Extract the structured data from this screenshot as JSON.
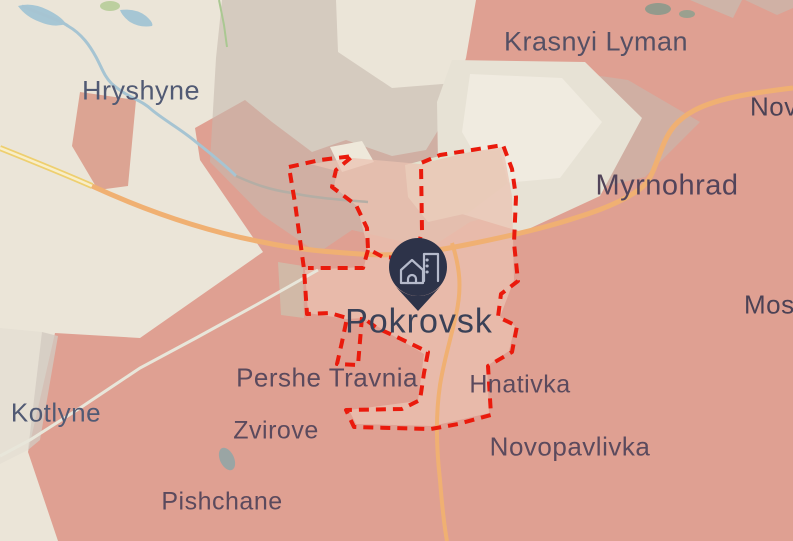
{
  "map": {
    "labels": [
      {
        "text": "Hryshyne",
        "kind": "town"
      },
      {
        "text": "Krasnyi Lyman",
        "kind": "town"
      },
      {
        "text": "Nov",
        "kind": "town-clipped"
      },
      {
        "text": "Myrnohrad",
        "kind": "town-large"
      },
      {
        "text": "Mos",
        "kind": "town-clipped"
      },
      {
        "text": "Pokrovsk",
        "kind": "city"
      },
      {
        "text": "Pershe Travnia",
        "kind": "village"
      },
      {
        "text": "Hnativka",
        "kind": "village"
      },
      {
        "text": "Kotlyne",
        "kind": "town"
      },
      {
        "text": "Zvirove",
        "kind": "village"
      },
      {
        "text": "Novopavlivka",
        "kind": "village"
      },
      {
        "text": "Pishchane",
        "kind": "village"
      }
    ],
    "pin": {
      "place": "Pokrovsk",
      "icon": "city-buildings-icon",
      "color": "#2d3349"
    },
    "colors": {
      "occupied_area": "#dfa092",
      "contested_area": "#c6b9af",
      "unoccupied_area": "#ebe5d8",
      "city_interior": "#ebc3b1",
      "frontline_boundary": "#ea1a0c",
      "road_primary": "#f0b072",
      "road_highway": "#eecf6f",
      "water": "#a6c4d2",
      "pin": "#2d3349"
    }
  }
}
